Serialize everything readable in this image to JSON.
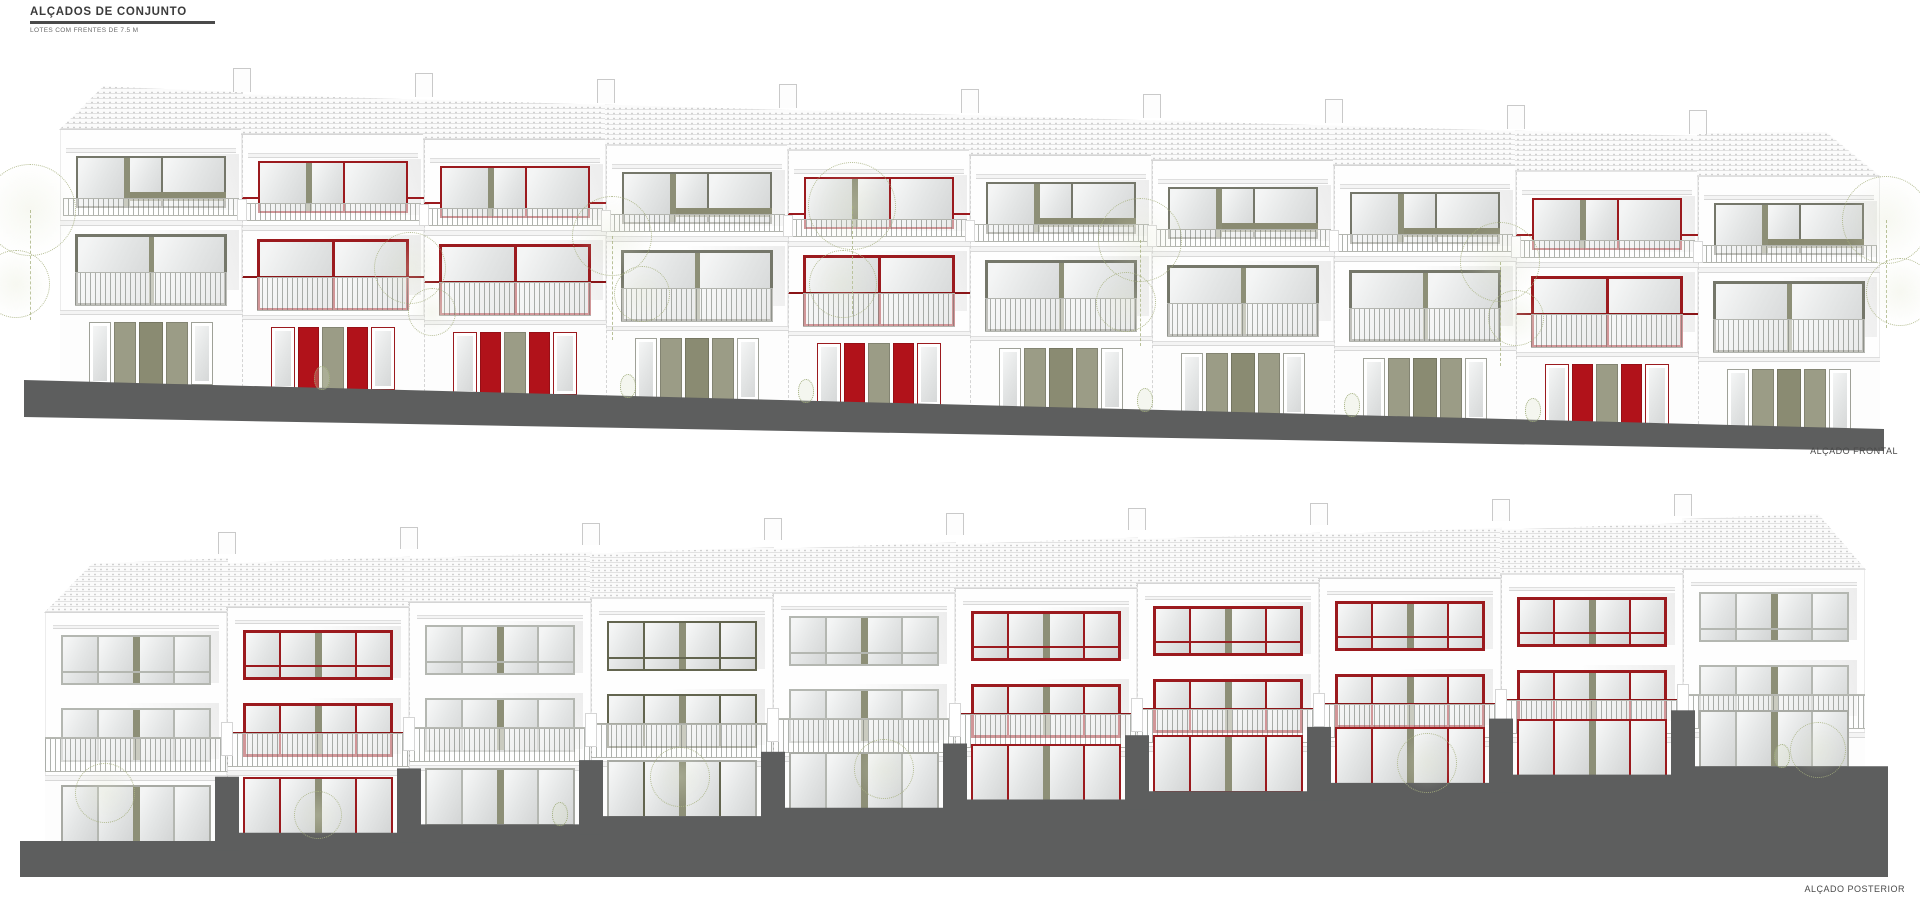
{
  "title_block": {
    "heading": "ALÇADOS DE CONJUNTO",
    "subheading": "LOTES COM FRENTES DE 7.5 M"
  },
  "colors": {
    "paper": "#ffffff",
    "ground": "#5d5e5e",
    "line": "#cfcfcf",
    "wall": "#fefefe",
    "glass_light": "#f4f5f5",
    "glass_dark": "#d3d5d5",
    "tree_outline": "#a8b280",
    "text_dark": "#3b3b3b",
    "text_label": "#4a4a4a"
  },
  "schemes": {
    "red": {
      "frame": "#9b1a1e",
      "mullion": "#8d8f77",
      "panel": "#b1121a",
      "panel2": "#9b9c86",
      "rail": "#8a1417"
    },
    "olive": {
      "frame": "#75776a",
      "mullion": "#8d8f77",
      "panel": "#9b9c86",
      "panel2": "#8a8b72",
      "rail": "#a9aba2"
    },
    "olivedark": {
      "frame": "#63654f",
      "mullion": "#8d8f77",
      "panel": "#8a8b72",
      "panel2": "#7b7c66",
      "rail": "#a9aba2"
    },
    "light": {
      "frame": "#b4b7b1",
      "mullion": "#8d8f77",
      "panel": "#9b9c86",
      "panel2": "#9b9c86",
      "rail": "#b7b9b3"
    }
  },
  "elevations": {
    "front": {
      "label": "ALÇADO FRONTAL",
      "units": [
        "olive",
        "red",
        "red",
        "olive",
        "red",
        "olive",
        "olive",
        "olive",
        "red",
        "olive"
      ],
      "trees": [
        {
          "x": 30,
          "y": 150,
          "r": 46
        },
        {
          "x": 16,
          "y": 224,
          "r": 34
        },
        {
          "x": 410,
          "y": 208,
          "r": 36
        },
        {
          "x": 432,
          "y": 252,
          "r": 24
        },
        {
          "x": 612,
          "y": 176,
          "r": 40
        },
        {
          "x": 642,
          "y": 234,
          "r": 28
        },
        {
          "x": 852,
          "y": 146,
          "r": 44
        },
        {
          "x": 843,
          "y": 224,
          "r": 34
        },
        {
          "x": 1140,
          "y": 180,
          "r": 42
        },
        {
          "x": 1126,
          "y": 242,
          "r": 30
        },
        {
          "x": 1500,
          "y": 202,
          "r": 40
        },
        {
          "x": 1516,
          "y": 258,
          "r": 28
        },
        {
          "x": 1886,
          "y": 160,
          "r": 44
        },
        {
          "x": 1900,
          "y": 232,
          "r": 34
        }
      ],
      "shrubs": [
        322,
        628,
        806,
        1145,
        1352,
        1533
      ]
    },
    "rear": {
      "label": "ALÇADO POSTERIOR",
      "units": [
        "light",
        "red",
        "light",
        "olivedark",
        "light",
        "red",
        "red",
        "red",
        "red",
        "light"
      ],
      "trees": [
        {
          "x": 105,
          "y": 368,
          "r": 30
        },
        {
          "x": 318,
          "y": 390,
          "r": 24
        },
        {
          "x": 680,
          "y": 352,
          "r": 30
        },
        {
          "x": 884,
          "y": 344,
          "r": 30
        },
        {
          "x": 1427,
          "y": 338,
          "r": 30
        },
        {
          "x": 1818,
          "y": 325,
          "r": 28
        }
      ],
      "shrubs": [
        560,
        1782
      ]
    }
  }
}
